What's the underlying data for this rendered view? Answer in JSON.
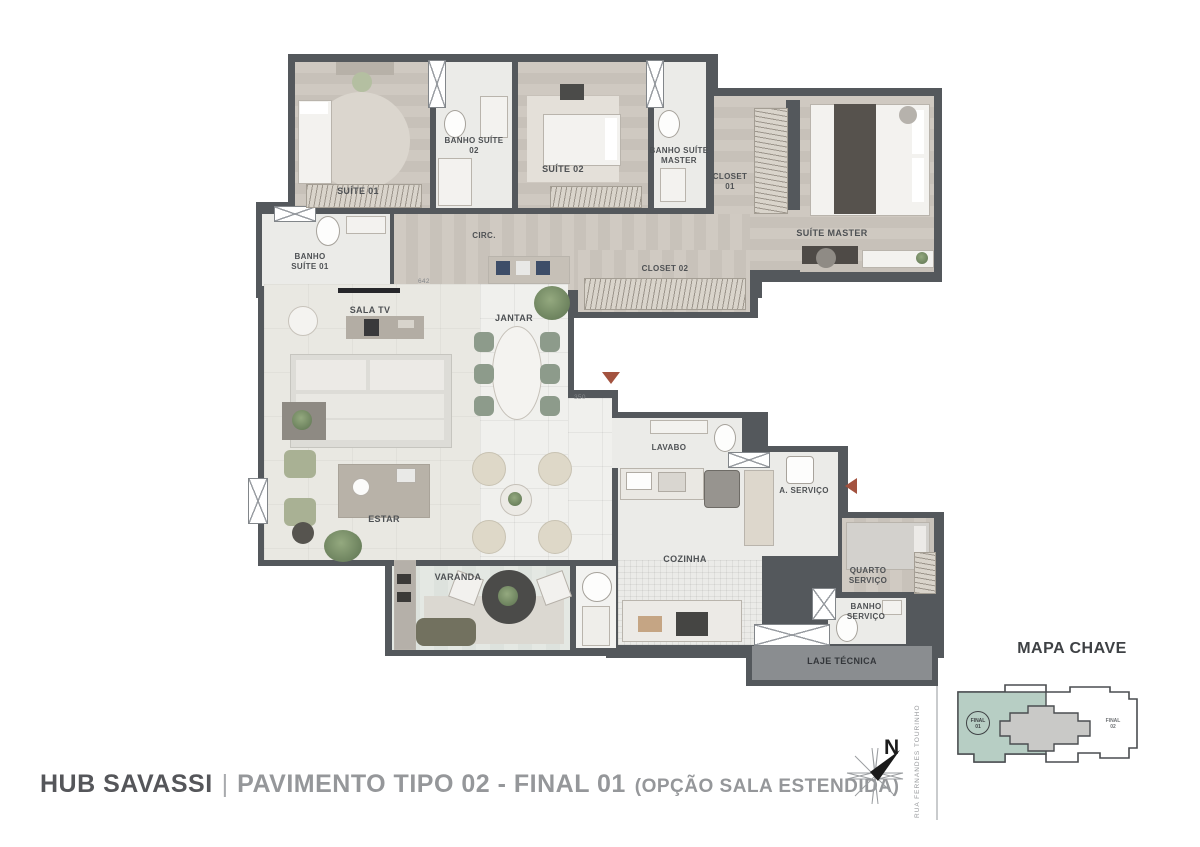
{
  "title": {
    "project": "HUB SAVASSI",
    "separator": "|",
    "plan": "PAVIMENTO TIPO 02 - FINAL 01",
    "option": "(OPÇÃO SALA ESTENDIDA)"
  },
  "rooms": {
    "suite_01": "SUÍTE 01",
    "banho_suite_02": "BANHO SUÍTE 02",
    "suite_02": "SUÍTE 02",
    "banho_suite_master": "BANHO SUÍTE MASTER",
    "closet_01": "CLOSET 01",
    "suite_master": "SUÍTE MASTER",
    "banho_suite_01": "BANHO SUÍTE 01",
    "circ": "CIRC.",
    "closet_02": "CLOSET 02",
    "sala_tv": "SALA TV",
    "jantar": "JANTAR",
    "estar": "ESTAR",
    "lavabo": "LAVABO",
    "a_servico": "A. SERVIÇO",
    "cozinha": "COZINHA",
    "quarto_servico": "QUARTO SERVIÇO",
    "banho_servico": "BANHO SERVIÇO",
    "varanda": "VARANDA",
    "laje_tecnica": "LAJE TÉCNICA"
  },
  "dimensions": {
    "wall_642": "642",
    "entry_350": "350"
  },
  "key_map": {
    "title": "MAPA CHAVE",
    "final01": {
      "line1": "FINAL",
      "line2": "01"
    },
    "final02": {
      "line1": "FINAL",
      "line2": "02"
    },
    "street": "RUA FERNANDES TOURINHO"
  },
  "compass": {
    "north_label": "N"
  },
  "colors": {
    "wall": "#54585c",
    "wood_floor": "#ccc6be",
    "tile_floor": "#ebebe8",
    "living_floor": "#e9e8e2",
    "varanda_floor": "#e4e8e3",
    "unit_highlight": "#b7cec4",
    "keymap_core": "#c9c9c7",
    "laje_fill": "#8a8d90",
    "entry_arrow": "#a3523f"
  }
}
